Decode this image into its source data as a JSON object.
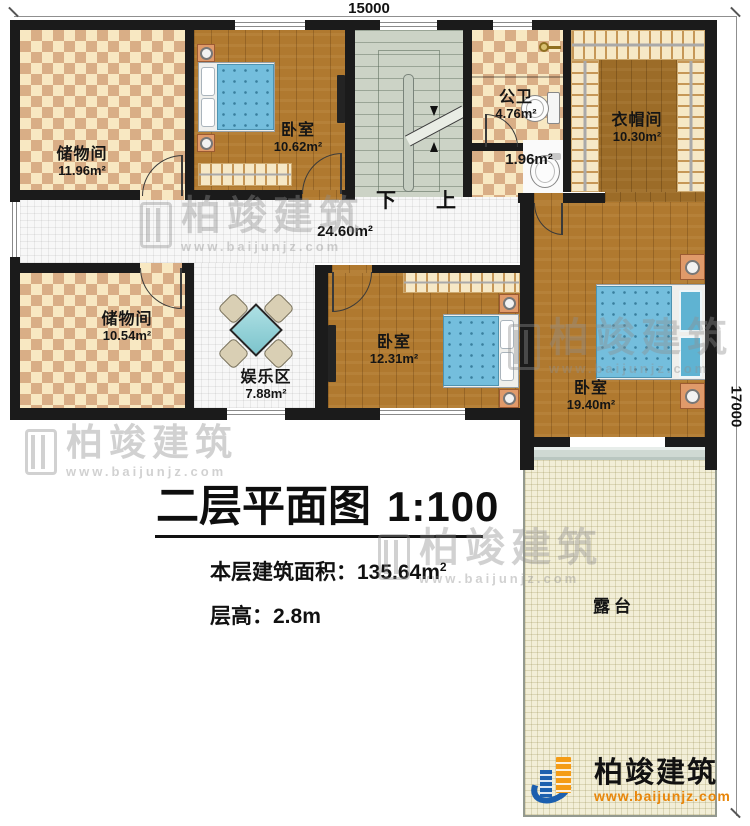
{
  "dimensions": {
    "top": "15000",
    "right": "17000"
  },
  "stairs": {
    "down_label": "下",
    "up_label": "上"
  },
  "rooms": {
    "storage1": {
      "name": "储物间",
      "area": "11.96m²"
    },
    "bedroom1": {
      "name": "卧室",
      "area": "10.62m²"
    },
    "bath": {
      "name": "公卫",
      "area": "4.76m²"
    },
    "wc": {
      "area": "1.96m²"
    },
    "cloakroom": {
      "name": "衣帽间",
      "area": "10.30m²"
    },
    "corridor": {
      "area": "24.60m²"
    },
    "storage2": {
      "name": "储物间",
      "area": "10.54m²"
    },
    "entertainment": {
      "name": "娱乐区",
      "area": "7.88m²"
    },
    "bedroom2": {
      "name": "卧室",
      "area": "12.31m²"
    },
    "bedroom3": {
      "name": "卧室",
      "area": "19.40m²"
    },
    "terrace": {
      "name": "露台"
    }
  },
  "title": {
    "main": "二层平面图",
    "scale": "1:100",
    "area_label": "本层建筑面积：",
    "area_value": "135.64m",
    "area_sup": "2",
    "height_label": "层高：",
    "height_value": "2.8m"
  },
  "watermark": {
    "brand": "柏竣建筑",
    "url": "www.baijunjz.com"
  },
  "logo": {
    "brand": "柏竣建筑",
    "url": "www.baijunjz.com"
  },
  "colors": {
    "wall": "#1b1b1b",
    "checker_light": "#f8e8c2",
    "checker_dark": "#d9ae86",
    "wood": "#b0792f",
    "wood_dark": "#9c6c28",
    "stair": "#ccd3c6",
    "tile": "#f7f7f7",
    "terrace": "#f2eed7",
    "bed_blue": "#74bedd",
    "table_teal": "#8ed2d8",
    "logo_blue": "#1c5fae",
    "logo_orange": "#f49c16",
    "watermark_gray": "#8f8f8f"
  }
}
